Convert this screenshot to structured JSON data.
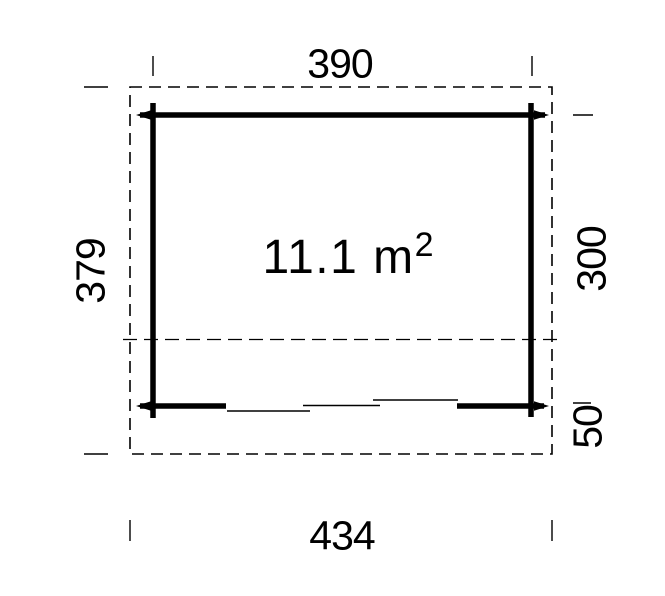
{
  "plan": {
    "area": {
      "text": "11.1 m",
      "exponent": "2"
    },
    "dimensions": {
      "top_wall_width": "390",
      "bottom_overall_width": "434",
      "left_overall_depth": "379",
      "right_wall_depth": "300",
      "right_overhang_depth": "50"
    },
    "colors": {
      "ink": "#000000",
      "background": "#ffffff"
    }
  }
}
